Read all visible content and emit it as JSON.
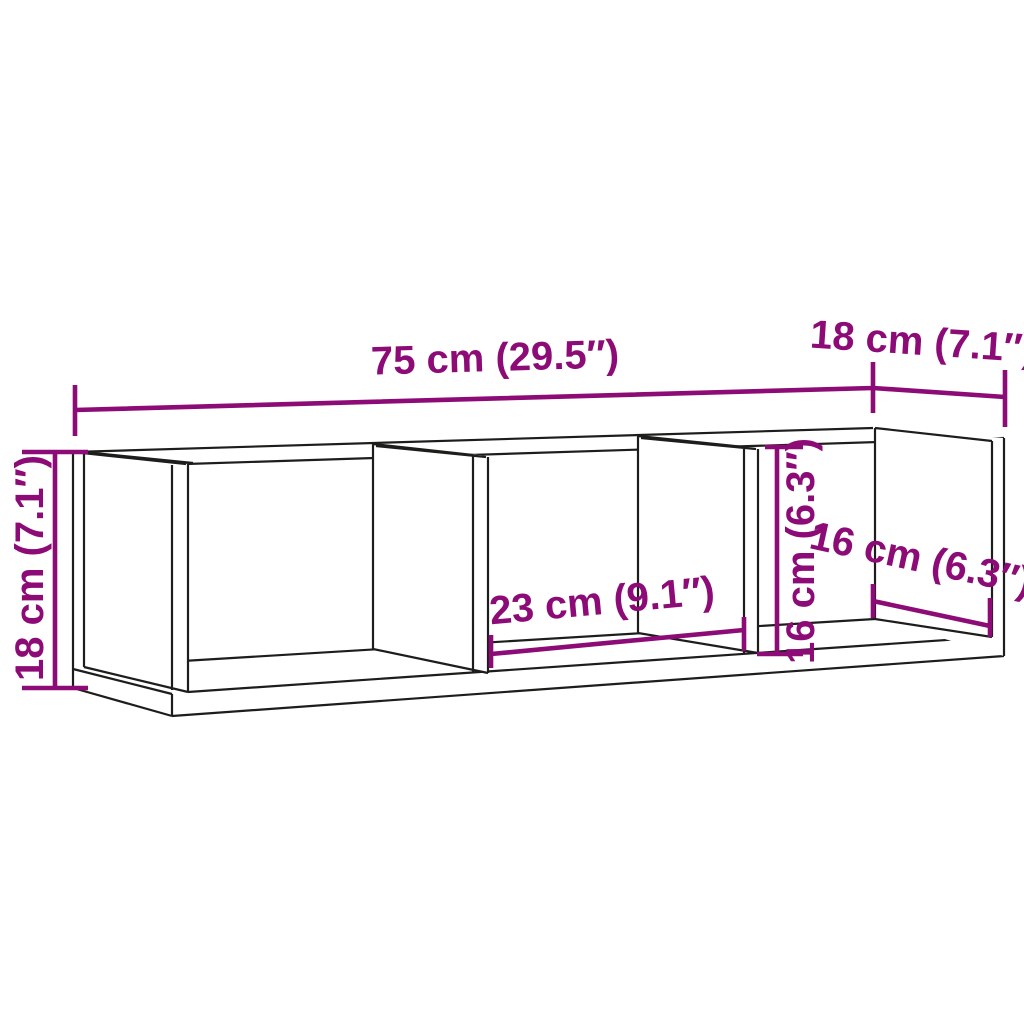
{
  "diagram": {
    "type": "furniture-dimension-diagram",
    "subject": "wall-mounted shelf with three open compartments",
    "background_color": "#ffffff",
    "outline_color": "#1d1d1b",
    "dimension_color": "#8d0b76",
    "dimensions": {
      "total_width": {
        "label": "75 cm (29.5″)",
        "meaning": "overall width, top edge"
      },
      "total_depth": {
        "label": "18 cm (7.1″)",
        "meaning": "overall depth, top right"
      },
      "total_height": {
        "label": "18 cm (7.1″)",
        "meaning": "overall height, left side"
      },
      "compartment_width": {
        "label": "23 cm (9.1″)",
        "meaning": "inner compartment width"
      },
      "compartment_height": {
        "label": "16 cm (6.3″)",
        "meaning": "inner compartment height"
      },
      "compartment_depth": {
        "label": "16 cm (6.3″)",
        "meaning": "inner compartment depth"
      }
    }
  }
}
